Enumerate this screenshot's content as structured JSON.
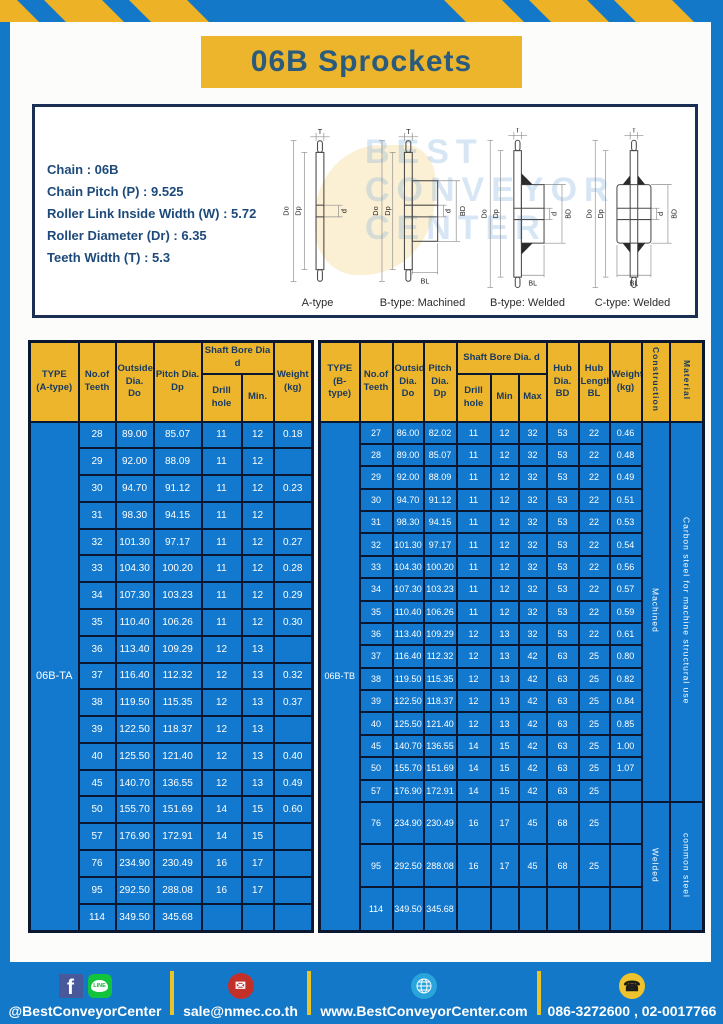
{
  "page": {
    "title": "06B Sprockets"
  },
  "specs": {
    "lines": [
      "Chain : 06B",
      "Chain Pitch (P) : 9.525",
      "Roller Link Inside Width (W) : 5.72",
      "Roller Diameter (Dr) : 6.35",
      "Teeth Width (T) : 5.3"
    ]
  },
  "diagrams": {
    "labels": [
      "A-type",
      "B-type: Machined",
      "B-type: Welded",
      "C-type: Welded"
    ],
    "dims": {
      "t": "T",
      "do": "Do",
      "dp": "Dp",
      "d": "d",
      "bd": "BD",
      "bl": "BL"
    }
  },
  "watermark": {
    "lines": [
      "BEST",
      "CONVEYOR",
      "CENTER"
    ]
  },
  "table_a": {
    "type_label": "06B-TA",
    "headers": {
      "type": "TYPE\n(A-type)",
      "teeth": "No.of\nTeeth",
      "outside": "Outside\nDia.\nDo",
      "pitch": "Pitch Dia.\nDp",
      "shaft_bore": "Shaft Bore Dia d",
      "drill": "Drill hole",
      "min": "Min.",
      "weight": "Weight\n(kg)"
    },
    "rows": [
      [
        "28",
        "89.00",
        "85.07",
        "11",
        "12",
        "0.18"
      ],
      [
        "29",
        "92.00",
        "88.09",
        "11",
        "12",
        ""
      ],
      [
        "30",
        "94.70",
        "91.12",
        "11",
        "12",
        "0.23"
      ],
      [
        "31",
        "98.30",
        "94.15",
        "11",
        "12",
        ""
      ],
      [
        "32",
        "101.30",
        "97.17",
        "11",
        "12",
        "0.27"
      ],
      [
        "33",
        "104.30",
        "100.20",
        "11",
        "12",
        "0.28"
      ],
      [
        "34",
        "107.30",
        "103.23",
        "11",
        "12",
        "0.29"
      ],
      [
        "35",
        "110.40",
        "106.26",
        "11",
        "12",
        "0.30"
      ],
      [
        "36",
        "113.40",
        "109.29",
        "12",
        "13",
        ""
      ],
      [
        "37",
        "116.40",
        "112.32",
        "12",
        "13",
        "0.32"
      ],
      [
        "38",
        "119.50",
        "115.35",
        "12",
        "13",
        "0.37"
      ],
      [
        "39",
        "122.50",
        "118.37",
        "12",
        "13",
        ""
      ],
      [
        "40",
        "125.50",
        "121.40",
        "12",
        "13",
        "0.40"
      ],
      [
        "45",
        "140.70",
        "136.55",
        "12",
        "13",
        "0.49"
      ],
      [
        "50",
        "155.70",
        "151.69",
        "14",
        "15",
        "0.60"
      ],
      [
        "57",
        "176.90",
        "172.91",
        "14",
        "15",
        ""
      ],
      [
        "76",
        "234.90",
        "230.49",
        "16",
        "17",
        ""
      ],
      [
        "95",
        "292.50",
        "288.08",
        "16",
        "17",
        ""
      ],
      [
        "114",
        "349.50",
        "345.68",
        "",
        "",
        ""
      ]
    ]
  },
  "table_b": {
    "type_label": "06B-TB",
    "headers": {
      "type": "TYPE\n(B-type)",
      "teeth": "No.of\nTeeth",
      "outside": "Outside\nDia.\nDo",
      "pitch": "Pitch\nDia.\nDp",
      "shaft_bore": "Shaft Bore Dia. d",
      "drill": "Drill hole",
      "min": "Min",
      "max": "Max",
      "hub_dia": "Hub\nDia.\nBD",
      "hub_len": "Hub\nLength\nBL",
      "weight": "Weight\n(kg)",
      "construction": "Construction",
      "material": "Material"
    },
    "rows": [
      [
        "27",
        "86.00",
        "82.02",
        "11",
        "12",
        "32",
        "53",
        "22",
        "0.46"
      ],
      [
        "28",
        "89.00",
        "85.07",
        "11",
        "12",
        "32",
        "53",
        "22",
        "0.48"
      ],
      [
        "29",
        "92.00",
        "88.09",
        "11",
        "12",
        "32",
        "53",
        "22",
        "0.49"
      ],
      [
        "30",
        "94.70",
        "91.12",
        "11",
        "12",
        "32",
        "53",
        "22",
        "0.51"
      ],
      [
        "31",
        "98.30",
        "94.15",
        "11",
        "12",
        "32",
        "53",
        "22",
        "0.53"
      ],
      [
        "32",
        "101.30",
        "97.17",
        "11",
        "12",
        "32",
        "53",
        "22",
        "0.54"
      ],
      [
        "33",
        "104.30",
        "100.20",
        "11",
        "12",
        "32",
        "53",
        "22",
        "0.56"
      ],
      [
        "34",
        "107.30",
        "103.23",
        "11",
        "12",
        "32",
        "53",
        "22",
        "0.57"
      ],
      [
        "35",
        "110.40",
        "106.26",
        "11",
        "12",
        "32",
        "53",
        "22",
        "0.59"
      ],
      [
        "36",
        "113.40",
        "109.29",
        "12",
        "13",
        "32",
        "53",
        "22",
        "0.61"
      ],
      [
        "37",
        "116.40",
        "112.32",
        "12",
        "13",
        "42",
        "63",
        "25",
        "0.80"
      ],
      [
        "38",
        "119.50",
        "115.35",
        "12",
        "13",
        "42",
        "63",
        "25",
        "0.82"
      ],
      [
        "39",
        "122.50",
        "118.37",
        "12",
        "13",
        "42",
        "63",
        "25",
        "0.84"
      ],
      [
        "40",
        "125.50",
        "121.40",
        "12",
        "13",
        "42",
        "63",
        "25",
        "0.85"
      ],
      [
        "45",
        "140.70",
        "136.55",
        "14",
        "15",
        "42",
        "63",
        "25",
        "1.00"
      ],
      [
        "50",
        "155.70",
        "151.69",
        "14",
        "15",
        "42",
        "63",
        "25",
        "1.07"
      ],
      [
        "57",
        "176.90",
        "172.91",
        "14",
        "15",
        "42",
        "63",
        "25",
        ""
      ],
      [
        "76",
        "234.90",
        "230.49",
        "16",
        "17",
        "45",
        "68",
        "25",
        ""
      ],
      [
        "95",
        "292.50",
        "288.08",
        "16",
        "17",
        "45",
        "68",
        "25",
        ""
      ],
      [
        "114",
        "349.50",
        "345.68",
        "",
        "",
        "",
        "",
        "",
        ""
      ]
    ],
    "span_cells": [
      {
        "at": 0,
        "span": 17,
        "label": "Machined",
        "name": "construction-cell"
      },
      {
        "at": 0,
        "span": 17,
        "label": "Carbon steel for machine structural use",
        "name": "material-cell"
      },
      {
        "at": 17,
        "span": 3,
        "label": "Welded",
        "name": "construction-cell"
      },
      {
        "at": 17,
        "span": 3,
        "label": "common steel",
        "name": "material-cell"
      }
    ]
  },
  "footer": {
    "social_handle": "@BestConveyorCenter",
    "email": "sale@nmec.co.th",
    "website": "www.BestConveyorCenter.com",
    "phone": "086-3272600 , 02-0017766",
    "icons": {
      "facebook": "f",
      "line": "LINE",
      "email": "✉",
      "phone": "☎"
    }
  },
  "colors": {
    "frame_blue": "#1478c8",
    "accent_yellow": "#edb52c",
    "cell_blue": "#1379cf",
    "header_text_navy": "#17395f",
    "title_text": "#2a5b7c",
    "table_border": "#0a1730"
  }
}
